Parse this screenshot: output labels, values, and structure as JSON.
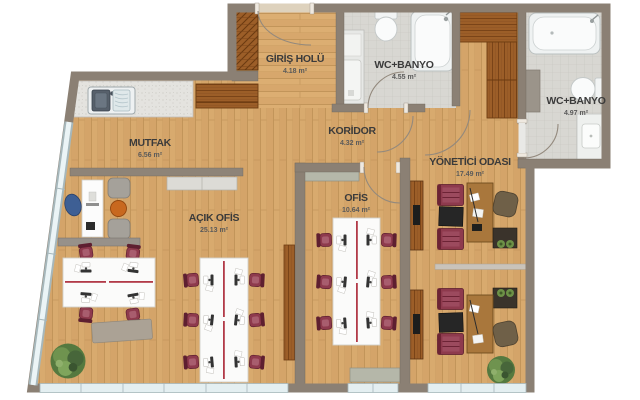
{
  "plan": {
    "type": "architectural-floor-plan",
    "rooms": [
      {
        "id": "mutfak",
        "name": "MUTFAK",
        "area": "6.56 m²"
      },
      {
        "id": "giris-holu",
        "name": "GİRİŞ HOLÜ",
        "area": "4.18 m²"
      },
      {
        "id": "wc-banyo-1",
        "name": "WC+BANYO",
        "area": "4.55 m²"
      },
      {
        "id": "wc-banyo-2",
        "name": "WC+BANYO",
        "area": "4.97 m²"
      },
      {
        "id": "koridor",
        "name": "KORİDOR",
        "area": "4.32 m²"
      },
      {
        "id": "ofis",
        "name": "OFİS",
        "area": "10.64 m²"
      },
      {
        "id": "yonetici-odasi",
        "name": "YÖNETİCİ ODASI",
        "area": "17.49 m²"
      },
      {
        "id": "acik-ofis",
        "name": "AÇIK OFİS",
        "area": "25.13 m²"
      }
    ],
    "colors": {
      "floor_wood": "#d8aa6e",
      "wall": "#8b8074",
      "bath_tile": "#d8d7d2",
      "dark_wood": "#9c5e28",
      "desk_white": "#fbfbfa",
      "desk_accent_red": "#b23a48",
      "chair_maroon": "#8e3a4d",
      "window_glass": "#e4eff1",
      "plant_green": "#55793f",
      "label_text": "#3b3b3b"
    }
  }
}
